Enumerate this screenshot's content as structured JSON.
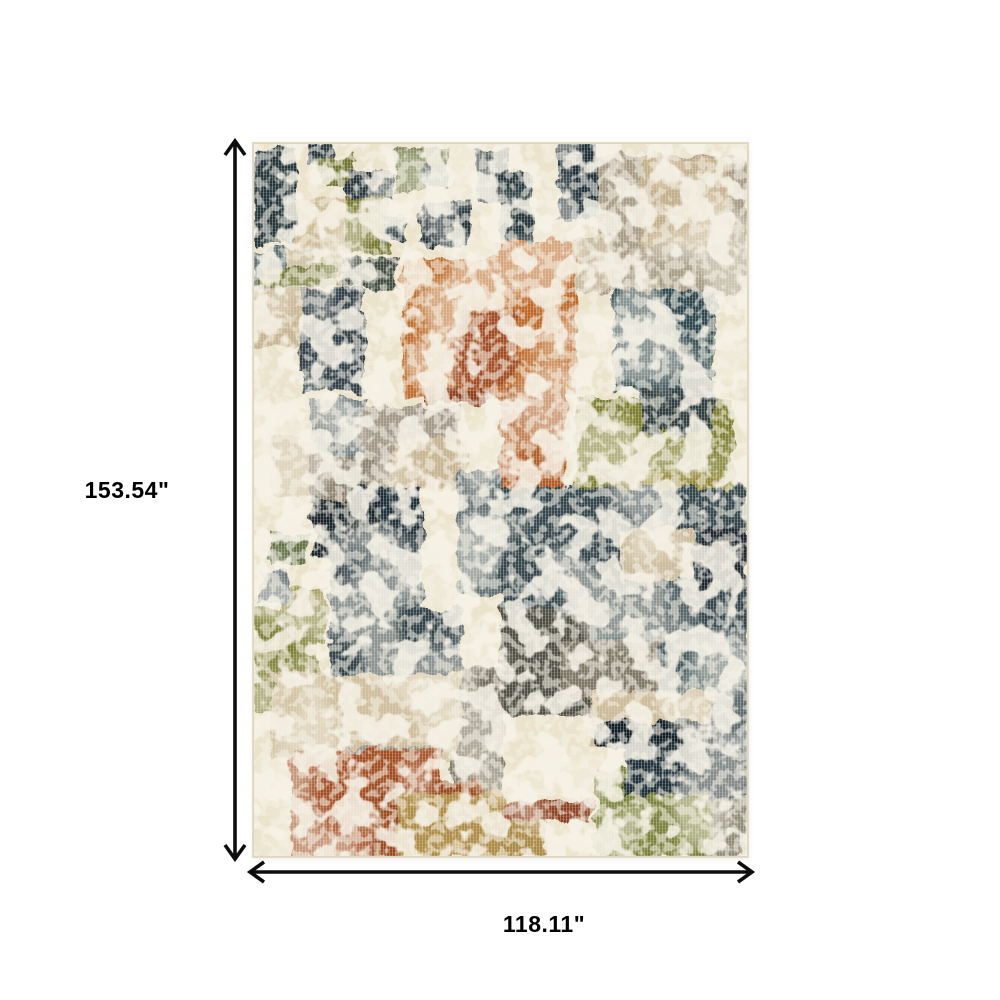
{
  "page": {
    "background": "#ffffff"
  },
  "annotation": {
    "height_label": "153.54\"",
    "width_label": "118.11\"",
    "arrow_color": "#0d0d0d",
    "label_color": "#000000"
  },
  "rug": {
    "description": "abstract distressed patchwork area rug",
    "base_color": "#EBE3CC",
    "edge_color": "#DFD6BE",
    "palette": {
      "navy": "#24343E",
      "dark_teal": "#2C4450",
      "slate": "#5E6E74",
      "olive": "#7A7B2F",
      "gold_olive": "#8E8433",
      "orange": "#BE6C2F",
      "rust": "#A04A20",
      "terracotta": "#8C3A1E",
      "gold": "#AD8A45",
      "tan": "#C6B392",
      "beige": "#CEBD9D",
      "taupe": "#A69B87",
      "gray": "#97958A",
      "cream": "#EBE3CC"
    },
    "blocks": [
      [
        2,
        6,
        42,
        96,
        "#24343E"
      ],
      [
        54,
        0,
        26,
        20,
        "#24343E"
      ],
      [
        66,
        14,
        34,
        30,
        "#6E7430"
      ],
      [
        94,
        28,
        48,
        26,
        "#20313D"
      ],
      [
        144,
        6,
        52,
        42,
        "#5C6A36"
      ],
      [
        170,
        20,
        26,
        26,
        "#24343E"
      ],
      [
        224,
        8,
        32,
        52,
        "#20313D"
      ],
      [
        247,
        28,
        32,
        72,
        "#24343E"
      ],
      [
        305,
        2,
        40,
        74,
        "#1F2F3B"
      ],
      [
        345,
        12,
        150,
        140,
        "#A69B87"
      ],
      [
        388,
        14,
        88,
        88,
        "#C2AE8C"
      ],
      [
        311,
        92,
        46,
        56,
        "#C8BBA2"
      ],
      [
        42,
        56,
        50,
        48,
        "#CDBA97"
      ],
      [
        92,
        54,
        44,
        58,
        "#71762F"
      ],
      [
        128,
        74,
        24,
        24,
        "#2A3C44"
      ],
      [
        168,
        58,
        48,
        44,
        "#20313D"
      ],
      [
        0,
        106,
        36,
        44,
        "#5A6E76"
      ],
      [
        32,
        102,
        60,
        50,
        "#CEC2A6"
      ],
      [
        8,
        124,
        76,
        20,
        "#6E7430"
      ],
      [
        88,
        115,
        56,
        30,
        "#3E4A42"
      ],
      [
        0,
        146,
        54,
        60,
        "#C4B18F"
      ],
      [
        150,
        116,
        104,
        140,
        "#BE6C2F"
      ],
      [
        247,
        98,
        76,
        154,
        "#BC6527"
      ],
      [
        200,
        168,
        64,
        74,
        "#A04A20"
      ],
      [
        170,
        244,
        66,
        18,
        "#8C3A1E"
      ],
      [
        48,
        146,
        64,
        102,
        "#2E3E4A"
      ],
      [
        360,
        148,
        102,
        100,
        "#2C4450"
      ],
      [
        58,
        255,
        52,
        92,
        "#66757B"
      ],
      [
        108,
        265,
        100,
        82,
        "#A1968A"
      ],
      [
        138,
        295,
        76,
        52,
        "#C6B392"
      ],
      [
        18,
        295,
        42,
        58,
        "#CBB999"
      ],
      [
        55,
        312,
        62,
        48,
        "#8A8172"
      ],
      [
        98,
        345,
        72,
        52,
        "#1E2E3A"
      ],
      [
        205,
        328,
        45,
        122,
        "#5E6E74"
      ],
      [
        247,
        247,
        66,
        100,
        "#B05A28"
      ],
      [
        323,
        255,
        158,
        126,
        "#7A7B2F"
      ],
      [
        388,
        247,
        72,
        42,
        "#2E3E42"
      ],
      [
        378,
        328,
        104,
        30,
        "#8E8433"
      ],
      [
        60,
        355,
        66,
        58,
        "#15222C"
      ],
      [
        77,
        388,
        92,
        110,
        "#31434E"
      ],
      [
        247,
        345,
        248,
        152,
        "#33454F"
      ],
      [
        368,
        385,
        72,
        52,
        "#C9BA9C"
      ],
      [
        448,
        385,
        47,
        62,
        "#1A2832"
      ],
      [
        18,
        390,
        36,
        32,
        "#5E7046"
      ],
      [
        28,
        445,
        46,
        52,
        "#8A8238"
      ],
      [
        6,
        428,
        30,
        32,
        "#5F6E76"
      ],
      [
        0,
        465,
        68,
        102,
        "#787B30"
      ],
      [
        77,
        465,
        132,
        76,
        "#2F4049"
      ],
      [
        247,
        465,
        94,
        108,
        "#4E4E44"
      ],
      [
        338,
        491,
        144,
        58,
        "#3E545C"
      ],
      [
        198,
        525,
        52,
        148,
        "#6E6A5C"
      ],
      [
        18,
        531,
        190,
        86,
        "#CEBD9D"
      ],
      [
        88,
        605,
        96,
        34,
        "#97958A"
      ],
      [
        307,
        497,
        100,
        60,
        "#7D7668"
      ],
      [
        338,
        548,
        126,
        58,
        "#CBBA9A"
      ],
      [
        458,
        485,
        37,
        156,
        "#5C6B72"
      ],
      [
        343,
        578,
        118,
        28,
        "#101E28"
      ],
      [
        38,
        608,
        150,
        106,
        "#A14B22"
      ],
      [
        118,
        638,
        112,
        76,
        "#97451E"
      ],
      [
        343,
        628,
        116,
        86,
        "#77813B"
      ],
      [
        373,
        600,
        90,
        52,
        "#1F2F3A"
      ],
      [
        455,
        605,
        40,
        52,
        "#22323C"
      ],
      [
        145,
        650,
        106,
        64,
        "#AD8A45"
      ],
      [
        247,
        678,
        46,
        36,
        "#A98845"
      ],
      [
        248,
        658,
        92,
        20,
        "#8C4020"
      ],
      [
        458,
        655,
        37,
        59,
        "#8E8B7C"
      ]
    ]
  }
}
